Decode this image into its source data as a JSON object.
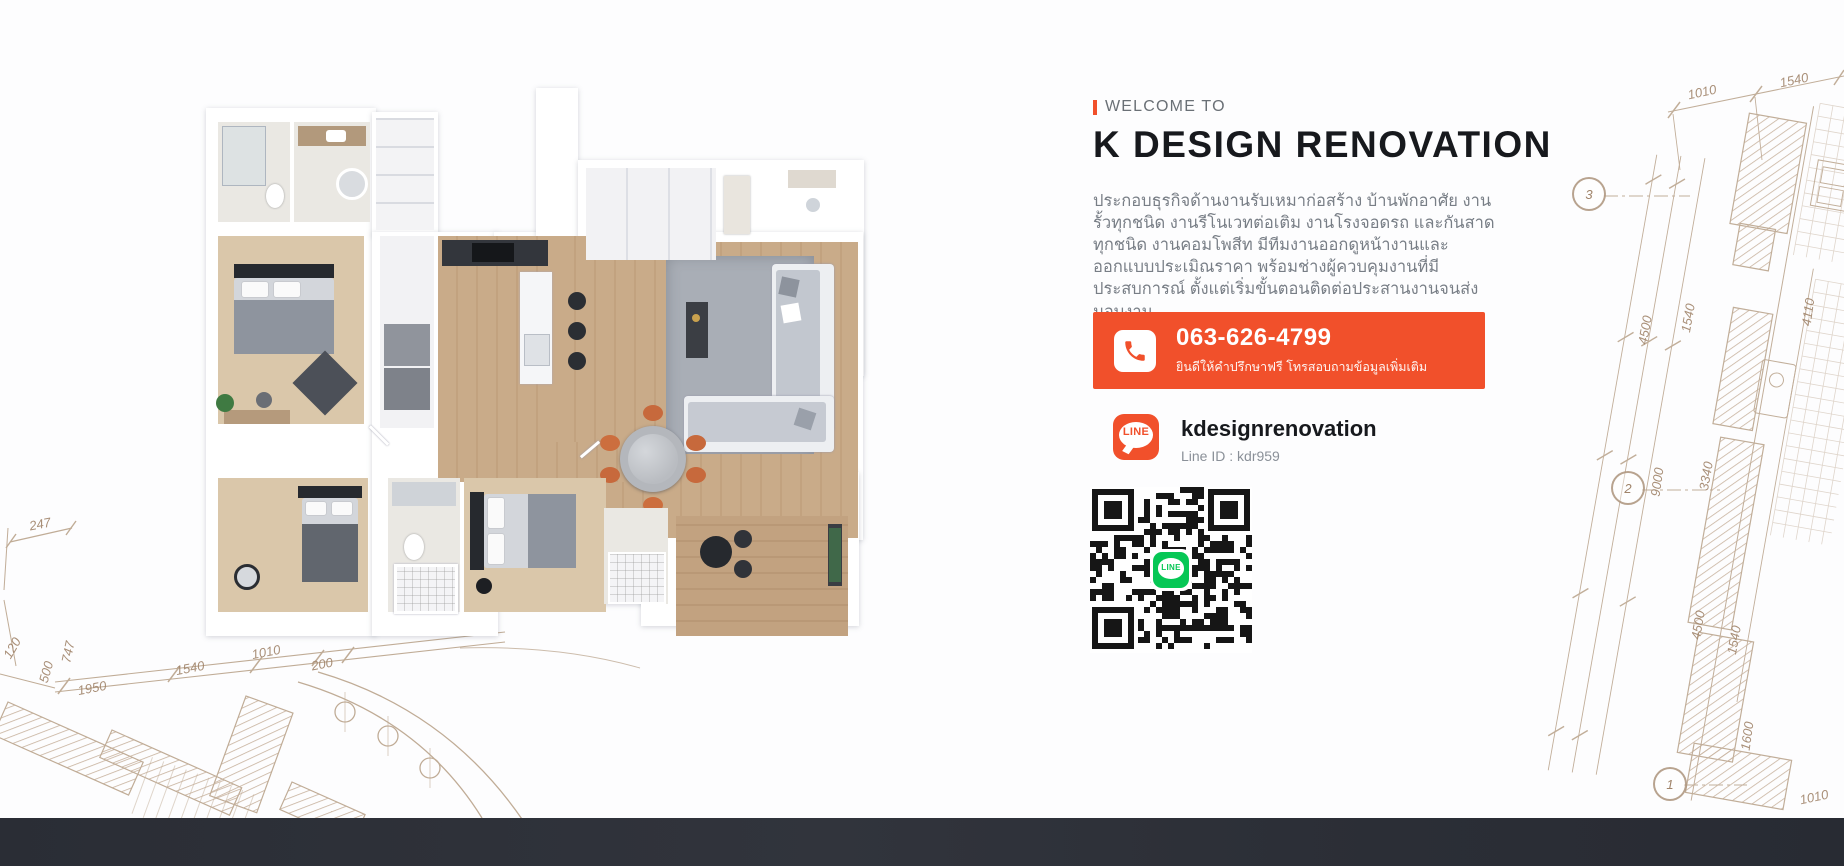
{
  "brand": {
    "accent": "#F1502B",
    "footer": "#2C2F37",
    "blueprint": "#A98D6F"
  },
  "hero": {
    "welcome_label": "WELCOME TO",
    "title": "K DESIGN RENOVATION",
    "description": "ประกอบธุรกิจด้านงานรับเหมาก่อสร้าง บ้านพักอาศัย งานรั้วทุกชนิด งานรีโนเวทต่อเติม งานโรงจอดรถ และกันสาดทุกชนิด งานคอมโพสีท มีทีมงานออกดูหน้างานและออกแบบประเมิณราคา พร้อมช่างผู้ควบคุมงานที่มีประสบการณ์ ตั้งแต่เริ่มขั้นตอนติดต่อประสานงานจนส่งมอบงาน",
    "phone": {
      "number": "063-626-4799",
      "subtitle": "ยินดีให้คำปรึกษาฟรี โทรสอบถามข้อมูลเพิ่มเติม"
    },
    "line": {
      "name": "kdesignrenovation",
      "id": "Line ID : kdr959",
      "badge": "LINE"
    }
  },
  "blueprint": {
    "labels": [
      {
        "t": "247",
        "x": 40,
        "y": 524,
        "r": -11
      },
      {
        "t": "120",
        "x": 12,
        "y": 648,
        "r": -60
      },
      {
        "t": "747",
        "x": 68,
        "y": 652,
        "r": -78
      },
      {
        "t": "500",
        "x": 46,
        "y": 672,
        "r": -74
      },
      {
        "t": "1950",
        "x": 92,
        "y": 688,
        "r": -11
      },
      {
        "t": "1540",
        "x": 190,
        "y": 668,
        "r": -11
      },
      {
        "t": "1010",
        "x": 266,
        "y": 652,
        "r": -11
      },
      {
        "t": "200",
        "x": 322,
        "y": 664,
        "r": -11
      },
      {
        "t": "1010",
        "x": 1702,
        "y": 92,
        "r": -12
      },
      {
        "t": "1540",
        "x": 1794,
        "y": 80,
        "r": -12
      },
      {
        "t": "4500",
        "x": 1645,
        "y": 330,
        "r": -80
      },
      {
        "t": "1540",
        "x": 1688,
        "y": 318,
        "r": -80
      },
      {
        "t": "4110",
        "x": 1808,
        "y": 312,
        "r": -82
      },
      {
        "t": "9000",
        "x": 1657,
        "y": 482,
        "r": -82
      },
      {
        "t": "3340",
        "x": 1706,
        "y": 476,
        "r": -80
      },
      {
        "t": "4500",
        "x": 1698,
        "y": 625,
        "r": -80
      },
      {
        "t": "1540",
        "x": 1734,
        "y": 640,
        "r": -80
      },
      {
        "t": "1600",
        "x": 1747,
        "y": 736,
        "r": -82
      },
      {
        "t": "1010",
        "x": 1814,
        "y": 797,
        "r": -12
      }
    ],
    "markers": [
      {
        "t": "3",
        "x": 1589,
        "y": 194
      },
      {
        "t": "2",
        "x": 1628,
        "y": 488
      },
      {
        "t": "1",
        "x": 1670,
        "y": 784
      }
    ]
  }
}
